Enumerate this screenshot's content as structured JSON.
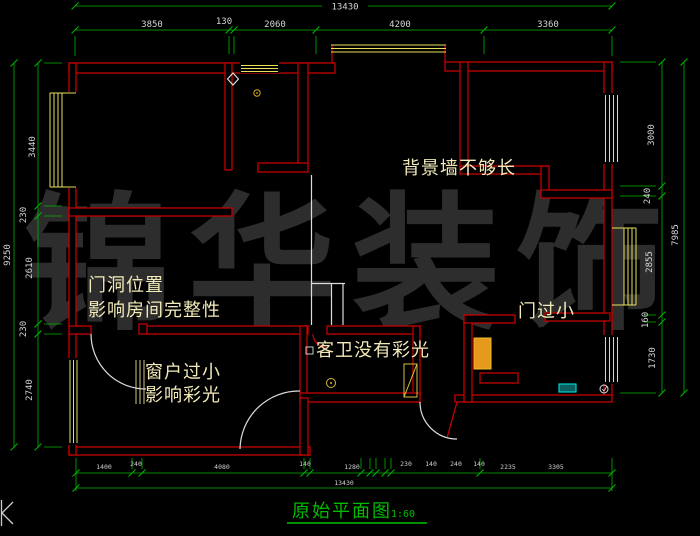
{
  "drawing_title": {
    "text": "原始平面图",
    "scale": "1:60"
  },
  "watermark": {
    "text": "锦华装饰"
  },
  "annotations": {
    "bg_wall": "背景墙不够长",
    "door_position_line1": "门洞位置",
    "door_position_line2": "影响房间完整性",
    "small_window_line1": "窗户过小",
    "small_window_line2": "影响彩光",
    "guest_bath": "客卫没有彩光",
    "small_door": "门过小"
  },
  "dimensions": {
    "top": {
      "total": "13430",
      "segments": [
        "3850",
        "130",
        "2060",
        "4200",
        "3360"
      ]
    },
    "left": {
      "total": "9250",
      "segments": [
        "3440",
        "230",
        "2610",
        "230",
        "2740"
      ]
    },
    "right": {
      "total": "7985",
      "segments": [
        "3000",
        "240",
        "2855",
        "160",
        "1730"
      ]
    },
    "bottom": {
      "total": "13430",
      "segments": [
        "1400",
        "240",
        "4080",
        "140",
        "1280",
        "230",
        "140",
        "240",
        "140",
        "2235",
        "3305"
      ]
    }
  },
  "colors": {
    "background": "#000000",
    "wall_red": "#c40000",
    "window_yellow": "#e9e05c",
    "dimension_green": "#00b400",
    "dimension_text": "#d4d4d4",
    "annotation_text": "#f2eab8",
    "title_green": "#00bd00",
    "watermark_gray": "#2d2d2d",
    "fixture_cyan": "#00dcdc",
    "fixture_orange": "#e59a1c",
    "stair_white": "#dcdcdc"
  },
  "icons": [
    "diamond-symbol-icon",
    "ceiling-lamp-icon",
    "floor-drain-icon",
    "door-leaf-icon",
    "sink-icon",
    "corner-mark-icon"
  ]
}
